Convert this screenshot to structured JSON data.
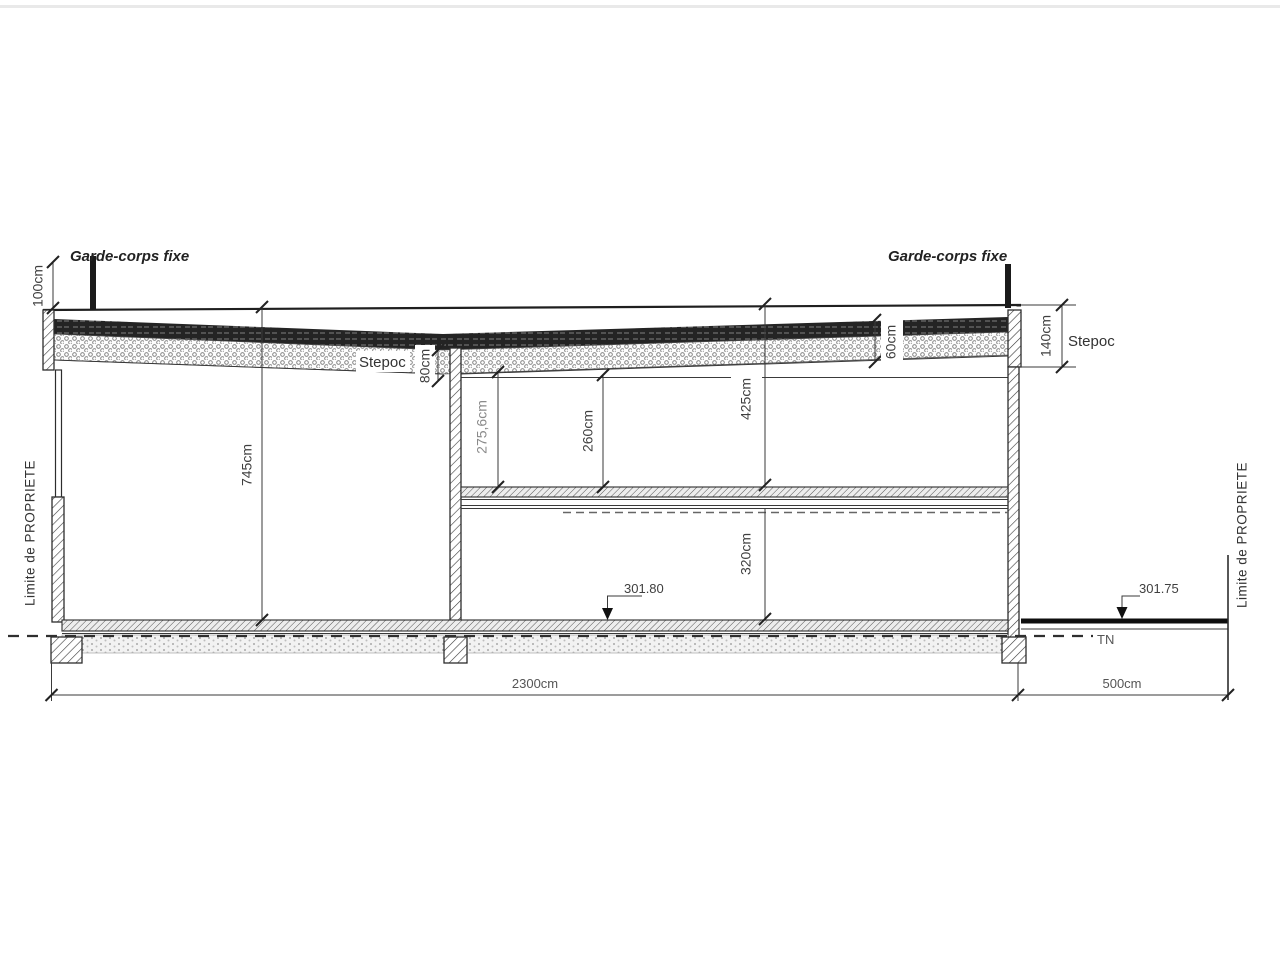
{
  "drawing": {
    "labels": {
      "garde_corps_left": "Garde-corps  fixe",
      "garde_corps_right": "Garde-corps  fixe",
      "property_limit_left": "Limite  de  PROPRIETE",
      "property_limit_right": "Limite  de  PROPRIETE",
      "stepoc_roof": "Stepoc",
      "stepoc_wall": "Stepoc",
      "natural_terrain": "TN"
    },
    "dimensions": {
      "railing_height": "100cm",
      "left_hall_height": "745cm",
      "roof_dip_depth": "80cm",
      "upper_room_height_left": "275,6cm",
      "upper_room_height_mid": "260cm",
      "upper_level_height": "425cm",
      "lower_level_height": "320cm",
      "roof_edge_depth": "60cm",
      "parapet_depth": "140cm",
      "building_length": "2300cm",
      "right_setback": "500cm"
    },
    "elevations": {
      "interior_floor": "301.80",
      "exterior_ground": "301.75"
    },
    "colors": {
      "ink": "#2e2e2e",
      "paper": "#ffffff"
    }
  }
}
